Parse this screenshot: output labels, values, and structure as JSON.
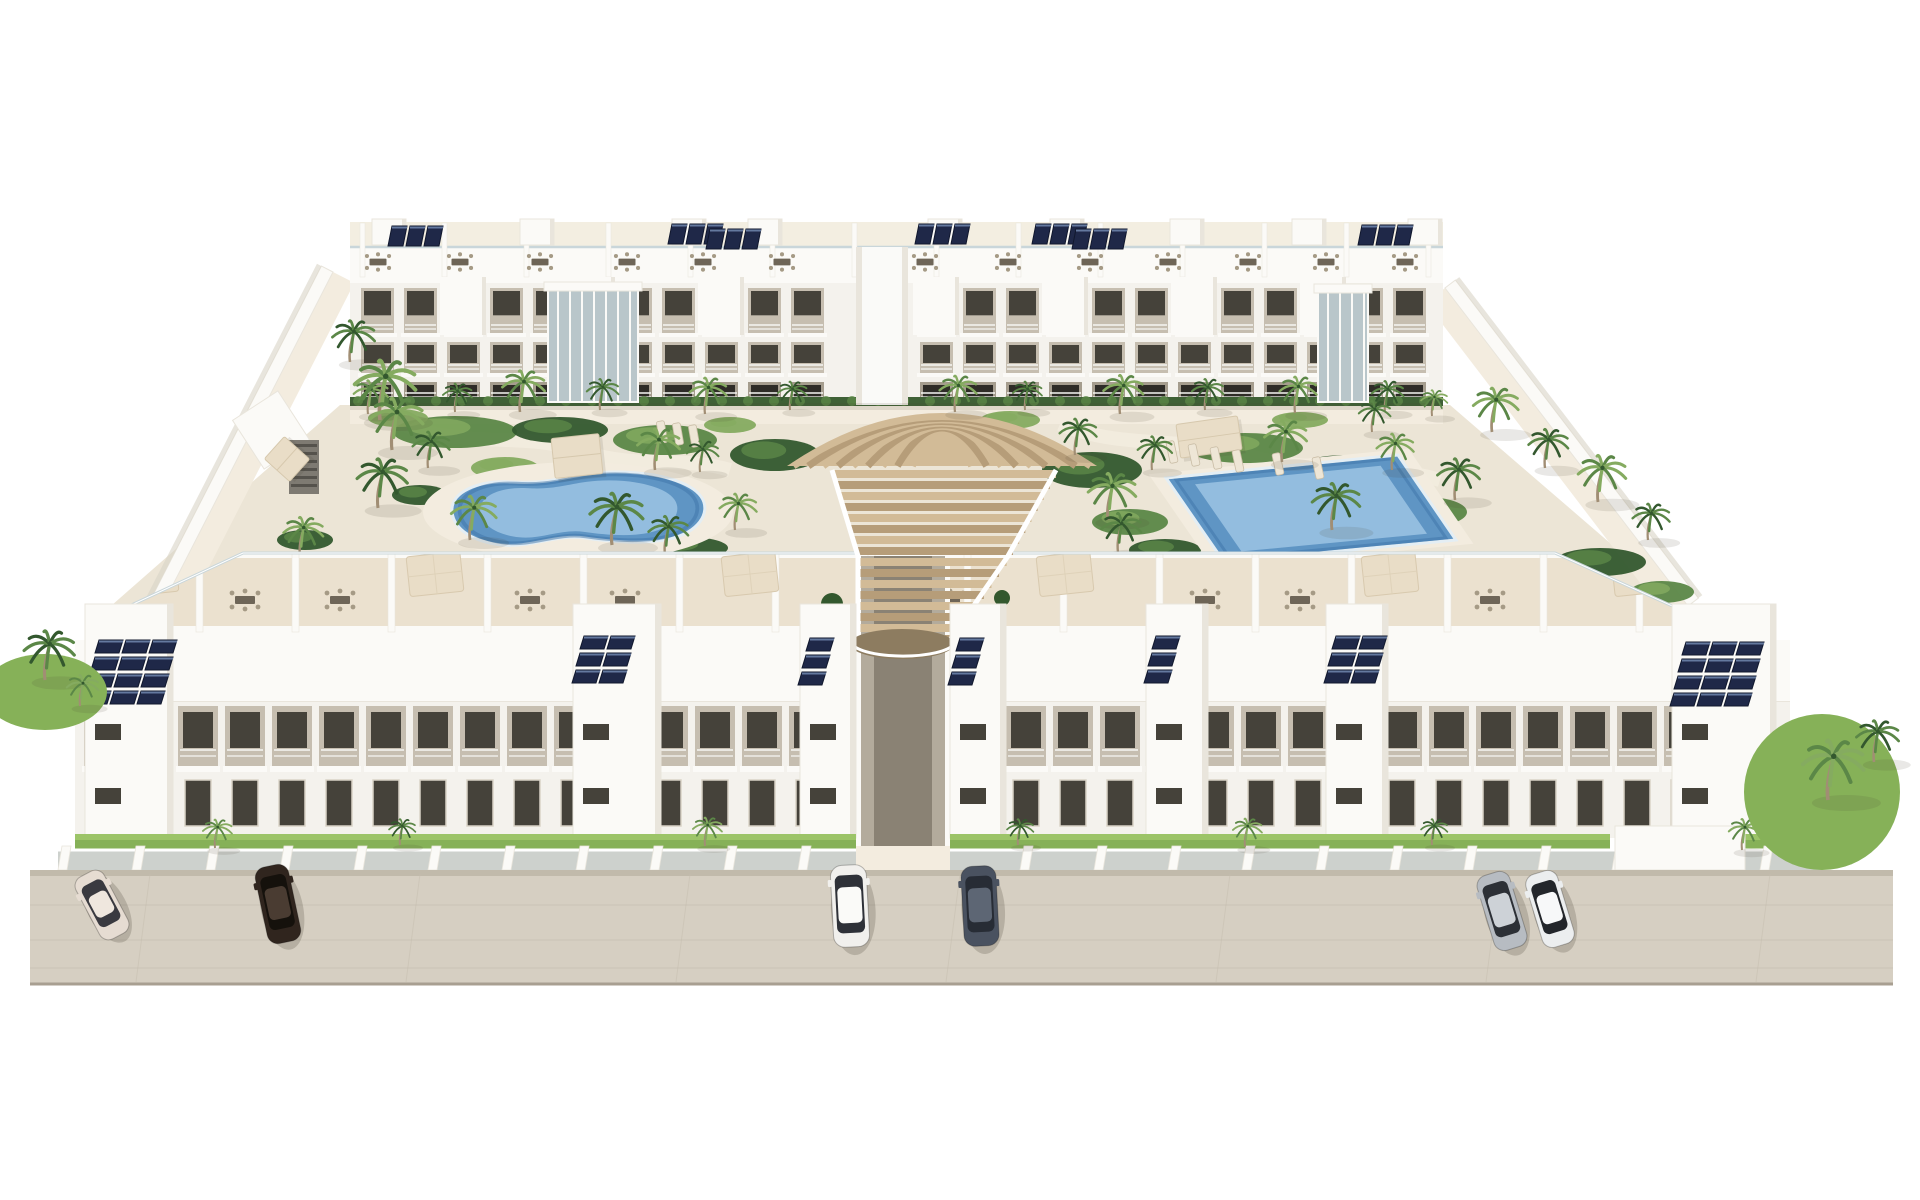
{
  "meta": {
    "type": "architectural-3d-render",
    "alt": "Aerial 3D render of a white Mediterranean apartment complex: two long three-storey blocks facing each other across a landscaped courtyard with a free-form pool, a rectangular pool, palm trees, a cascading timber stair deck in the centre, rooftop terraces with pergolas and solar panels, private street-level gardens behind a glass fence, and six cars parked on a beige street."
  },
  "palette": {
    "bg": "#ffffff",
    "white_hi": "#fbfaf7",
    "white": "#f4f2ed",
    "white_shade": "#e9e5dc",
    "white_dark": "#d9d3c7",
    "courtyard": "#ece5d6",
    "path_light": "#f3ecdf",
    "terrace_floor": "#ebe1cf",
    "recess": "#c6beb0",
    "recess_deep": "#a59d8e",
    "window_dark": "#45423a",
    "window_deep": "#2e2c27",
    "glass_blue": "#b9c6ca",
    "rail": "#f6f6f3",
    "balustrade": "#c9d6da",
    "hedge": "#3f6136",
    "grass": "#86b158",
    "grass_hi": "#9cc468",
    "green_dark": "#33582e",
    "green_mid": "#5b8747",
    "green_light": "#85ab60",
    "trunk": "#a18e74",
    "solar": "#1f2848",
    "solar_hi": "#64799f",
    "solar_frame": "#11182e",
    "timber": "#d2bb97",
    "timber_dark": "#b69d79",
    "timber_deep": "#8d7c60",
    "pool_deep": "#3e74a8",
    "pool_mid": "#5f95c4",
    "pool_light": "#9cc4e4",
    "pool_rim": "#e4eef4",
    "street": "#d6cfc2",
    "street_line": "#c6beb0",
    "street_edge": "#a89f91",
    "fence_glass": "#cdd1cd",
    "parasol": "#e9ddc7",
    "furn": "#6e6557",
    "furn_light": "#a59a85",
    "shadow": "rgba(70,66,50,0.22)",
    "shadow_soft": "rgba(70,66,50,0.12)"
  },
  "scene": {
    "canvas": {
      "w": 1920,
      "h": 1200
    },
    "courtyard_poly": [
      [
        340,
        405
      ],
      [
        1450,
        405
      ],
      [
        1690,
        612
      ],
      [
        1560,
        556
      ],
      [
        240,
        556
      ],
      [
        95,
        620
      ]
    ],
    "back_path": {
      "x1": 350,
      "x2": 1443,
      "y1": 405,
      "y2": 424
    },
    "walls": {
      "left": [
        [
          333,
          272
        ],
        [
          160,
          610
        ]
      ],
      "right": [
        [
          1445,
          288
        ],
        [
          1688,
          606
        ]
      ],
      "width": 13,
      "walkway": 24
    },
    "left_features": {
      "ramp": [
        244,
        401,
        54,
        58
      ],
      "stair": [
        289,
        440,
        30,
        54
      ],
      "bench": [
        272,
        442,
        30,
        32
      ]
    },
    "back_building": {
      "x1": 350,
      "x2": 1443,
      "gap": [
        856,
        908
      ],
      "roof_top": 219,
      "parapet_y": 247,
      "roof_face_h": 36,
      "floors": [
        [
          283,
          54
        ],
        [
          337,
          40
        ],
        [
          377,
          28
        ]
      ],
      "base": 405,
      "bay_step": 43,
      "roof_div_step": 82,
      "bulkheads": [
        372,
        520,
        672,
        748,
        928,
        1050,
        1170,
        1292,
        1408
      ],
      "roof_dining": [
        378,
        460,
        540,
        627,
        703,
        782,
        925,
        1008,
        1090,
        1168,
        1248,
        1326,
        1405
      ],
      "solar": [
        [
          388,
          226,
          3
        ],
        [
          668,
          224,
          3
        ],
        [
          706,
          229,
          3
        ],
        [
          915,
          224,
          3
        ],
        [
          1032,
          224,
          3
        ],
        [
          1072,
          229,
          3
        ],
        [
          1358,
          225,
          3
        ]
      ],
      "stair_bays": [
        [
          548,
          290,
          90,
          112
        ],
        [
          1318,
          292,
          50,
          110
        ]
      ]
    },
    "deck": {
      "cx": 942,
      "fan_top": 372,
      "fan_base": 466,
      "fan_rmin": 22,
      "fan_rmax": 112,
      "fan_step": 11,
      "casc_top": 470,
      "casc_mid": 556,
      "casc_bottom": 640,
      "xl": [
        832,
        858,
        858
      ],
      "xr": [
        1056,
        1008,
        950
      ],
      "slat": 11,
      "shrubs": [
        [
          832,
          604,
          11
        ],
        [
          1002,
          598,
          8
        ]
      ]
    },
    "pools": {
      "kidney": {
        "apron": [
          578,
          512,
          155,
          50
        ],
        "path": "M 452,512 C 450,492 478,480 512,482 C 545,484 560,478 588,474 C 625,469 668,474 690,487 C 712,500 708,520 688,532 C 664,546 620,543 585,538 C 556,534 530,548 502,545 C 474,542 454,530 452,512 Z",
        "cx": 580,
        "cy": 510
      },
      "rect": {
        "outer": [
          [
            1166,
            478
          ],
          [
            1398,
            455
          ],
          [
            1456,
            540
          ],
          [
            1224,
            562
          ]
        ],
        "cx": 1311,
        "cy": 509
      }
    },
    "pergolas": [
      [
        553,
        436,
        48,
        40,
        -6
      ],
      [
        1178,
        420,
        62,
        34,
        -8
      ],
      [
        272,
        442,
        30,
        34,
        -48
      ]
    ],
    "loungers": [
      [
        662,
        432,
        -10
      ],
      [
        678,
        434,
        -10
      ],
      [
        694,
        436,
        -10
      ],
      [
        1172,
        452,
        -12
      ],
      [
        1194,
        455,
        -12
      ],
      [
        1216,
        458,
        -12
      ],
      [
        1238,
        461,
        -12
      ],
      [
        1278,
        464,
        -12
      ],
      [
        1318,
        468,
        -12
      ]
    ],
    "garden_beds": [
      [
        455,
        432,
        62,
        16,
        2
      ],
      [
        560,
        430,
        48,
        13,
        1
      ],
      [
        665,
        440,
        52,
        15,
        2
      ],
      [
        505,
        468,
        34,
        11,
        3
      ],
      [
        420,
        495,
        28,
        10,
        1
      ],
      [
        775,
        455,
        45,
        16,
        1
      ],
      [
        1092,
        470,
        50,
        18,
        1
      ],
      [
        1130,
        522,
        38,
        13,
        2
      ],
      [
        1245,
        448,
        58,
        15,
        2
      ],
      [
        1345,
        472,
        52,
        17,
        1
      ],
      [
        1425,
        512,
        42,
        15,
        2
      ],
      [
        1600,
        562,
        46,
        14,
        1
      ],
      [
        1662,
        592,
        32,
        11,
        2
      ],
      [
        245,
        588,
        36,
        11,
        2
      ],
      [
        305,
        540,
        28,
        10,
        1
      ],
      [
        688,
        548,
        40,
        11,
        1
      ],
      [
        1165,
        550,
        36,
        11,
        1
      ],
      [
        398,
        418,
        30,
        9,
        3
      ],
      [
        730,
        425,
        26,
        8,
        3
      ],
      [
        1010,
        420,
        30,
        9,
        3
      ],
      [
        1300,
        420,
        28,
        8,
        3
      ]
    ],
    "palms_courtyard": [
      [
        368,
        414,
        0.65,
        1
      ],
      [
        455,
        412,
        0.55,
        0
      ],
      [
        520,
        412,
        0.8,
        1
      ],
      [
        600,
        410,
        0.6,
        0
      ],
      [
        705,
        414,
        0.7,
        1
      ],
      [
        790,
        410,
        0.55,
        0
      ],
      [
        955,
        412,
        0.7,
        1
      ],
      [
        1025,
        410,
        0.55,
        0
      ],
      [
        1120,
        414,
        0.75,
        1
      ],
      [
        1205,
        410,
        0.6,
        0
      ],
      [
        1295,
        413,
        0.7,
        1
      ],
      [
        1385,
        412,
        0.6,
        0
      ],
      [
        1432,
        416,
        0.5,
        1
      ],
      [
        380,
        420,
        1.15,
        1
      ],
      [
        350,
        362,
        0.8,
        0
      ],
      [
        392,
        450,
        1.0,
        1
      ],
      [
        428,
        468,
        0.7,
        0
      ],
      [
        378,
        508,
        0.95,
        0
      ],
      [
        300,
        556,
        0.75,
        1
      ],
      [
        252,
        585,
        0.6,
        0
      ],
      [
        470,
        540,
        0.85,
        1
      ],
      [
        612,
        545,
        1.0,
        0
      ],
      [
        655,
        470,
        0.8,
        1
      ],
      [
        700,
        472,
        0.6,
        0
      ],
      [
        735,
        530,
        0.7,
        1
      ],
      [
        1075,
        455,
        0.7,
        0
      ],
      [
        1108,
        520,
        0.9,
        1
      ],
      [
        1152,
        470,
        0.65,
        0
      ],
      [
        1282,
        462,
        0.8,
        1
      ],
      [
        1332,
        530,
        0.9,
        0
      ],
      [
        1392,
        470,
        0.7,
        1
      ],
      [
        1455,
        500,
        0.8,
        0
      ],
      [
        1372,
        432,
        0.6,
        0
      ],
      [
        1492,
        432,
        0.85,
        1
      ],
      [
        1545,
        468,
        0.75,
        0
      ],
      [
        1598,
        502,
        0.9,
        1
      ],
      [
        1648,
        540,
        0.7,
        0
      ],
      [
        665,
        555,
        0.75,
        0
      ],
      [
        1118,
        552,
        0.75,
        0
      ]
    ],
    "palms_front": [
      [
        215,
        848,
        0.55,
        1
      ],
      [
        400,
        845,
        0.5,
        0
      ],
      [
        705,
        846,
        0.55,
        1
      ],
      [
        1018,
        845,
        0.5,
        0
      ],
      [
        1245,
        847,
        0.55,
        1
      ],
      [
        1432,
        845,
        0.5,
        0
      ],
      [
        1742,
        850,
        0.6,
        1
      ]
    ],
    "palms_corners": [
      [
        45,
        680,
        0.95,
        0
      ],
      [
        80,
        706,
        0.6,
        1
      ],
      [
        1828,
        800,
        1.15,
        1
      ],
      [
        1874,
        762,
        0.8,
        0
      ]
    ],
    "front_building": {
      "terrace_poly": [
        [
          95,
          622
        ],
        [
          243,
          553
        ],
        [
          1555,
          553
        ],
        [
          1690,
          614
        ],
        [
          1690,
          650
        ],
        [
          95,
          650
        ]
      ],
      "floor_y": 558,
      "floor_h": 68,
      "parapet_face_y": 626,
      "div_x0": 100,
      "div_x1": 1780,
      "div_step": 96,
      "parasols": [
        150,
        435,
        750,
        1065,
        1390,
        1640
      ],
      "dining": [
        245,
        340,
        530,
        625,
        950,
        1205,
        1300,
        1490
      ],
      "solar_band": {
        "x": 75,
        "y": 640,
        "w": 1715,
        "h": 62
      },
      "towers": [
        [
          85,
          88
        ],
        [
          573,
          88
        ],
        [
          800,
          56
        ],
        [
          950,
          56
        ],
        [
          1146,
          62
        ],
        [
          1326,
          62
        ],
        [
          1672,
          104
        ]
      ],
      "tower_y": 604,
      "tower_bottom": 838,
      "solar": [
        [
          95,
          640,
          3,
          4
        ],
        [
          580,
          636,
          2,
          3
        ],
        [
          806,
          638,
          1,
          3
        ],
        [
          956,
          638,
          1,
          3
        ],
        [
          1152,
          636,
          1,
          3
        ],
        [
          1332,
          636,
          2,
          3
        ],
        [
          1682,
          642,
          3,
          4
        ]
      ],
      "facade": {
        "left": [
          75,
          856
        ],
        "right": [
          950,
          1790
        ],
        "y": 702,
        "h": 136,
        "bay_step": 47
      },
      "alley": [
        856,
        950
      ],
      "grass": [
        [
          75,
          834,
          781,
          18
        ],
        [
          950,
          834,
          660,
          18
        ],
        [
          1745,
          834,
          70,
          18
        ]
      ],
      "fence": {
        "x0": 58,
        "x1": 1822,
        "y": 846,
        "h": 24,
        "pier_step": 74
      },
      "gate_block": [
        1615,
        826,
        130,
        44
      ],
      "entry_pad": [
        856,
        846,
        94,
        26
      ]
    },
    "street": {
      "x0": 30,
      "x1": 1893,
      "y0": 870,
      "y1": 984,
      "joints_v": [
        150,
        420,
        690,
        960,
        1230,
        1500,
        1770
      ],
      "joints_h": [
        905,
        940,
        968
      ]
    },
    "corner_gardens": {
      "left": [
        45,
        692,
        62,
        38
      ],
      "right": [
        1822,
        792,
        78,
        78
      ]
    },
    "cars": [
      {
        "label": "beige sedan",
        "x": 102,
        "y": 905,
        "angle": -28,
        "len": 70,
        "wid": 32,
        "body": "#e6dcd2",
        "roof": "#efe7de",
        "glass": "#3a3a40"
      },
      {
        "label": "dark brown sedan",
        "x": 278,
        "y": 904,
        "angle": -12,
        "len": 78,
        "wid": 34,
        "body": "#30251e",
        "roof": "#4a3c32",
        "glass": "#15110c"
      },
      {
        "label": "white van",
        "x": 850,
        "y": 906,
        "angle": -3,
        "len": 82,
        "wid": 36,
        "body": "#f1f0ed",
        "roof": "#fafaf8",
        "glass": "#2e3138"
      },
      {
        "label": "dark gray car",
        "x": 980,
        "y": 906,
        "angle": -3,
        "len": 80,
        "wid": 35,
        "body": "#4a5260",
        "roof": "#5d6674",
        "glass": "#272c35"
      },
      {
        "label": "silver van",
        "x": 1502,
        "y": 911,
        "angle": -17,
        "len": 78,
        "wid": 34,
        "body": "#b7bcc2",
        "roof": "#cdd2d7",
        "glass": "#2c3036"
      },
      {
        "label": "white sedan",
        "x": 1550,
        "y": 909,
        "angle": -17,
        "len": 76,
        "wid": 33,
        "body": "#eceeef",
        "roof": "#f7f8f9",
        "glass": "#23262b"
      }
    ]
  }
}
